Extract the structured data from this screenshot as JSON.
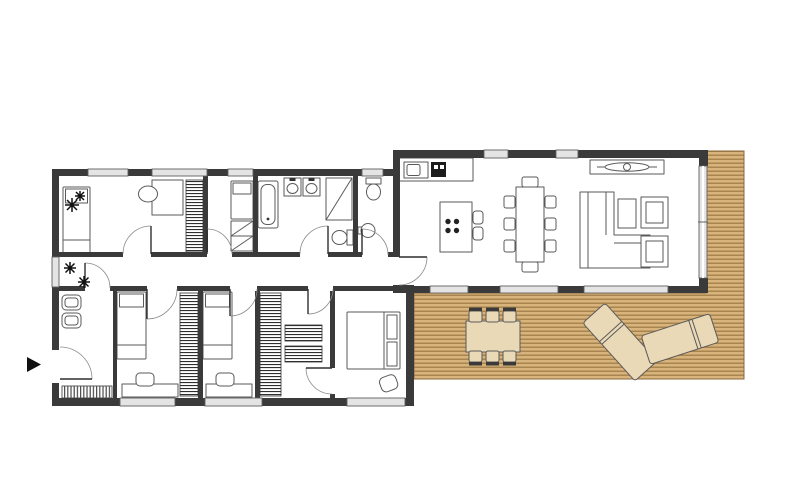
{
  "canvas": {
    "width": 800,
    "height": 482,
    "background": "#ffffff"
  },
  "colors": {
    "wall": "#3a3a3a",
    "glass": "#e4e4e4",
    "glass_edge": "#5f5f5f",
    "furniture_stroke": "#5a5a5a",
    "furniture_fill": "#ffffff",
    "deck_base": "#d9b37c",
    "deck_line": "#a8854f",
    "deck_border": "#8a6a3c",
    "outdoor_fill": "#ead9b6",
    "hatch": "#2e2e2e",
    "arrow": "#111111",
    "door_leaf": "#2f2f2f",
    "door_arc": "#8a8a8a",
    "plant": "#111111"
  },
  "floor_plan": {
    "type": "architectural-floor-plan",
    "entrance_marker": "arrow-right",
    "wings": [
      {
        "name": "bedroom-wing",
        "rooms": [
          "entry",
          "hallway",
          "bedroom-1",
          "bedroom-2",
          "bathroom",
          "wc",
          "bedroom-3",
          "bedroom-4",
          "walk-in-closet",
          "master-bedroom"
        ]
      },
      {
        "name": "living-wing",
        "rooms": [
          "kitchen",
          "dining-area",
          "living-area"
        ]
      }
    ],
    "outdoor": {
      "name": "deck",
      "plank_lines": "horizontal",
      "furniture": [
        "outdoor-dining-table",
        "outdoor-chairs-x6",
        "sun-lounger-1",
        "sun-lounger-2"
      ]
    },
    "furniture_symbols": [
      "single-bed",
      "double-bed",
      "wardrobe-hatched",
      "desk",
      "chair",
      "toilet",
      "washbasin",
      "double-washbasin",
      "bathtub",
      "shower",
      "doormat",
      "plant",
      "kitchen-counter",
      "kitchen-sink",
      "stove",
      "kitchen-island-cooktop",
      "bar-stool",
      "dining-table",
      "dining-chair",
      "fireplace",
      "l-sofa",
      "coffee-table",
      "armchair"
    ]
  }
}
